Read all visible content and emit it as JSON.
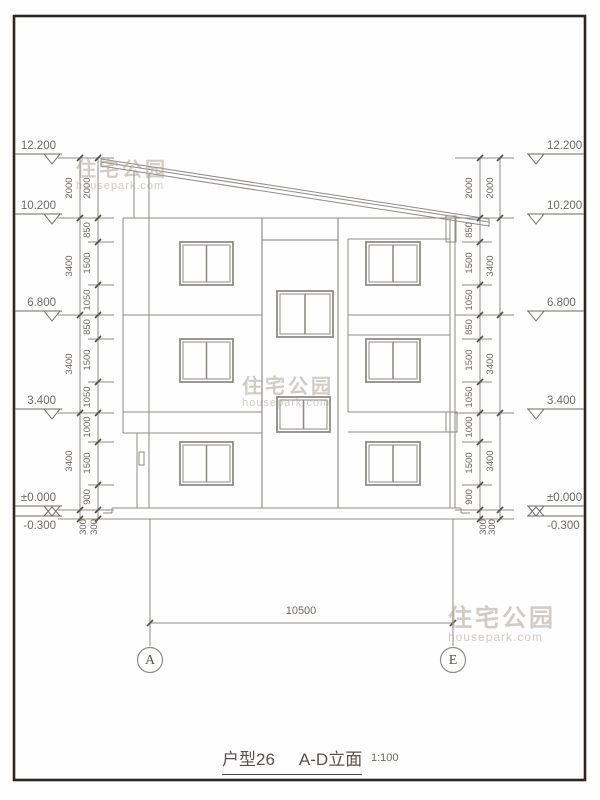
{
  "title": {
    "project": "户型26",
    "view": "A-D立面",
    "scale": "1:100"
  },
  "watermark": {
    "cn": "住宅公园",
    "en": "housepark.com"
  },
  "grid": {
    "left_bubble": "A",
    "right_bubble": "E",
    "overall_width": "10500"
  },
  "elevations": [
    "12.200",
    "10.200",
    "6.800",
    "3.400",
    "±0.000",
    "-0.300"
  ],
  "dim_chain_floor": [
    "2000",
    "3400",
    "3400",
    "3400",
    "300"
  ],
  "dim_chain_detail": [
    "2000",
    "850",
    "1500",
    "1050",
    "850",
    "1500",
    "1050",
    "1000",
    "1500",
    "900",
    "300"
  ]
}
